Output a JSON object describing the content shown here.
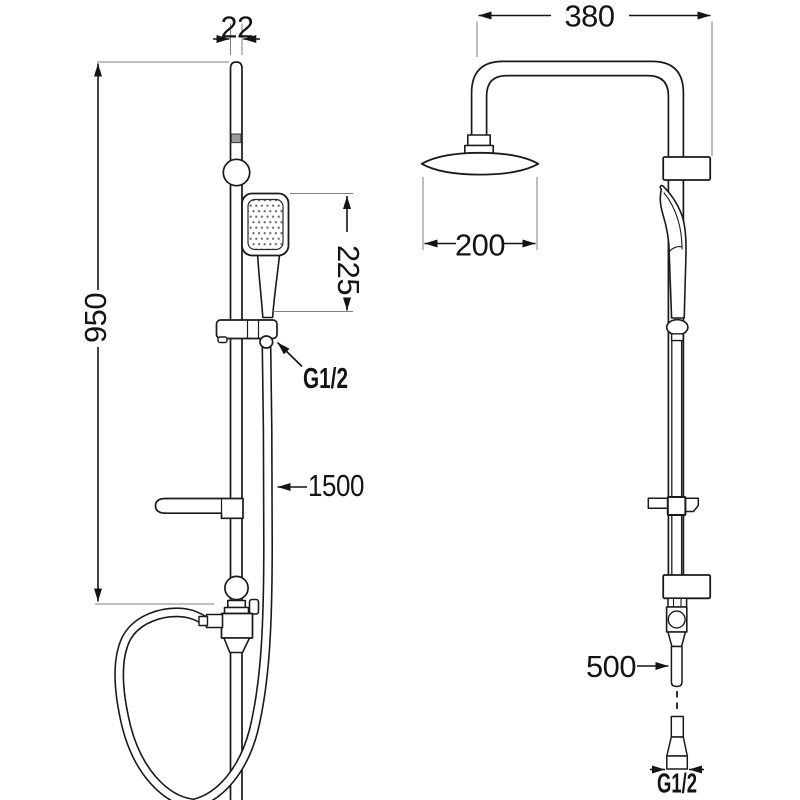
{
  "drawing": {
    "title": "shower-column-technical-drawing",
    "colors": {
      "line": "#1a1a1a",
      "extension_line": "#7f7f7f",
      "gray_band": "#9a9a9a",
      "background": "#ffffff",
      "nozzle_dots": "#6e6e6e"
    },
    "left_view": {
      "dim_rail_diameter": "22",
      "dim_rail_height": "950",
      "dim_handshower_length": "225",
      "label_hose_thread": "G1/2",
      "dim_hose_length": "1500"
    },
    "right_view": {
      "dim_arm_span": "380",
      "dim_head_diameter": "200",
      "dim_lower_hose_length": "500",
      "label_connector_thread": "G1/2"
    }
  }
}
